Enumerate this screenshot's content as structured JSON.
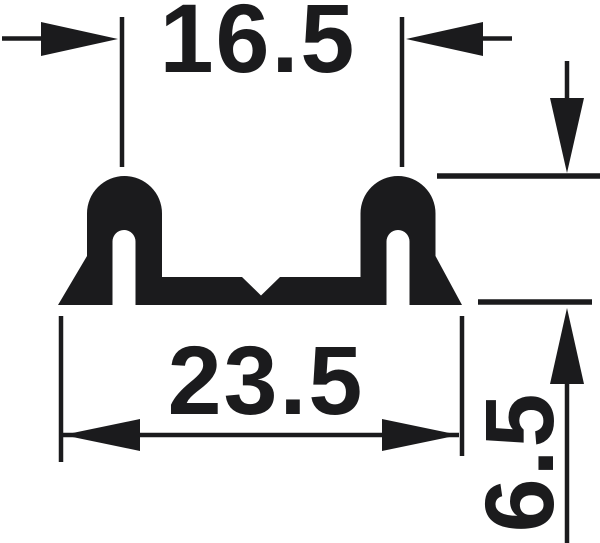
{
  "drawing": {
    "background_color": "#ffffff",
    "ink_color": "#1b1b1d",
    "dimensions": {
      "top_slot_spacing": {
        "value": "16.5"
      },
      "base_width": {
        "value": "23.5"
      },
      "profile_height": {
        "value": "6.5"
      }
    }
  }
}
